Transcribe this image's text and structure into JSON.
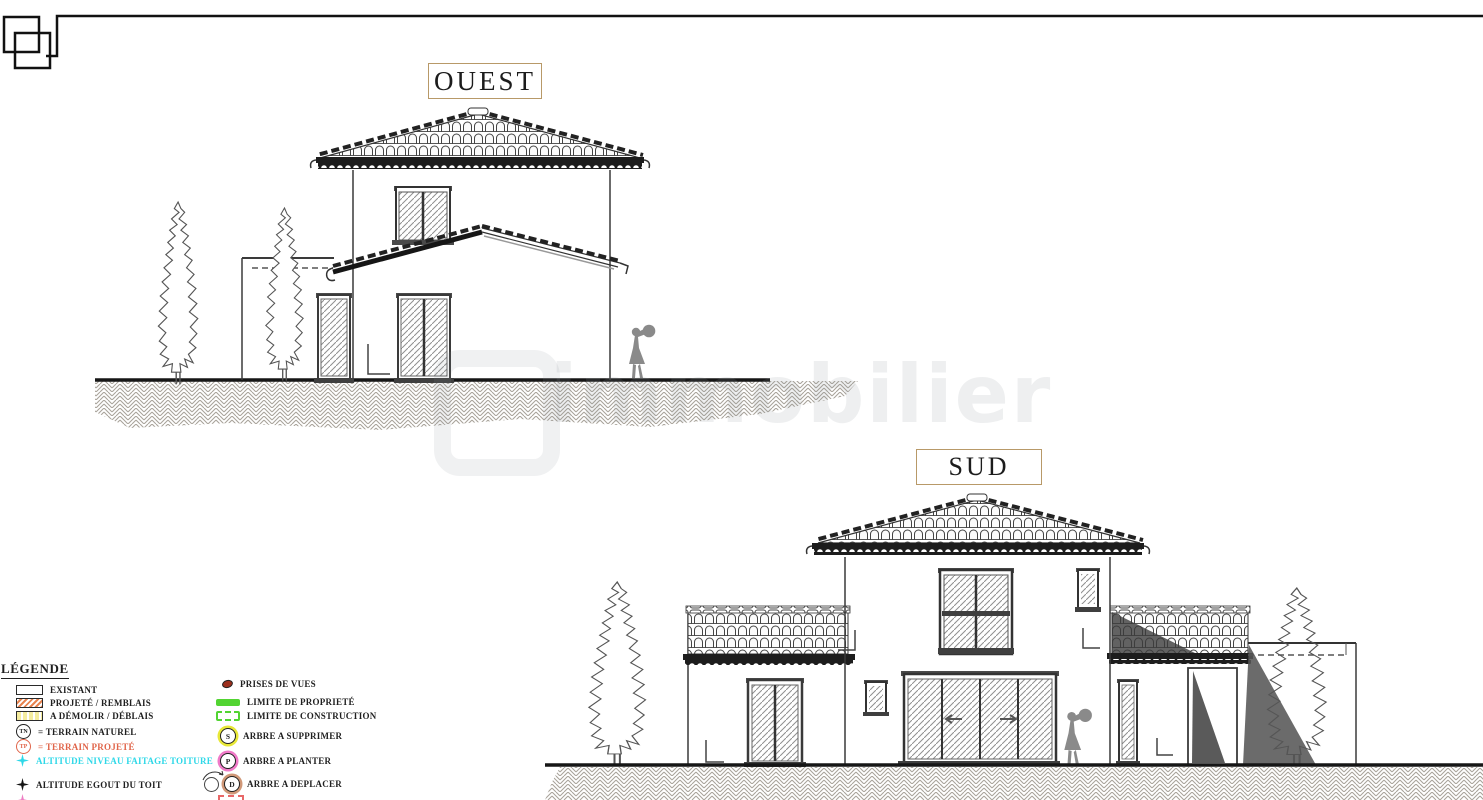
{
  "sheet": {
    "type": "facade-elevations-architectural-drawing"
  },
  "labels": {
    "west": "OUEST",
    "south": "SUD"
  },
  "watermark": {
    "text": "immobilier"
  },
  "legend": {
    "title": "LÉGENDE",
    "left_items": [
      {
        "id": "existant",
        "label": "EXISTANT"
      },
      {
        "id": "projete-remblais",
        "label": "PROJETÉ / REMBLAIS"
      },
      {
        "id": "a-demolir-deblais",
        "label": "A DÉMOLIR / DÉBLAIS"
      },
      {
        "id": "terrain-naturel",
        "symbol_text": "TN",
        "label": "= TERRAIN  NATUREL"
      },
      {
        "id": "terrain-projete",
        "symbol_text": "TP",
        "label": "= TERRAIN PROJETÉ"
      },
      {
        "id": "altitude-faitage",
        "label": "ALTITUDE NIVEAU FAITAGE TOITURE"
      },
      {
        "id": "altitude-egout",
        "label": "ALTITUDE EGOUT DU TOIT"
      }
    ],
    "right_items": [
      {
        "id": "prises-de-vues",
        "label": "PRISES DE VUES"
      },
      {
        "id": "limite-propriete",
        "label": "LIMITE DE PROPRIETÉ"
      },
      {
        "id": "limite-construction",
        "label": "LIMITE DE CONSTRUCTION"
      },
      {
        "id": "arbre-a-supprimer",
        "symbol_text": "S",
        "label": "ARBRE A SUPPRIMER"
      },
      {
        "id": "arbre-a-planter",
        "symbol_text": "P",
        "label": "ARBRE A PLANTER"
      },
      {
        "id": "arbre-a-deplacer",
        "symbol_text": "D",
        "label": "ARBRE A DEPLACER"
      }
    ]
  },
  "colors": {
    "label_box_border": "#b89968",
    "terrain_projete_red": "#e0654a",
    "faitage_cyan": "#2fd8e8",
    "limite_green": "#52d432",
    "supprimer_ring_yellow": "#e8e838",
    "planter_ring_pink": "#f07ac8",
    "deplacer_ring_tan": "#d09878",
    "prises_de_vues_red": "#9c2f1d",
    "projete_hatch_orange": "#e8834f",
    "demolir_yellow": "#f5ec9e",
    "shadow_gray": "#565656",
    "line_black": "#1d1d1d"
  }
}
